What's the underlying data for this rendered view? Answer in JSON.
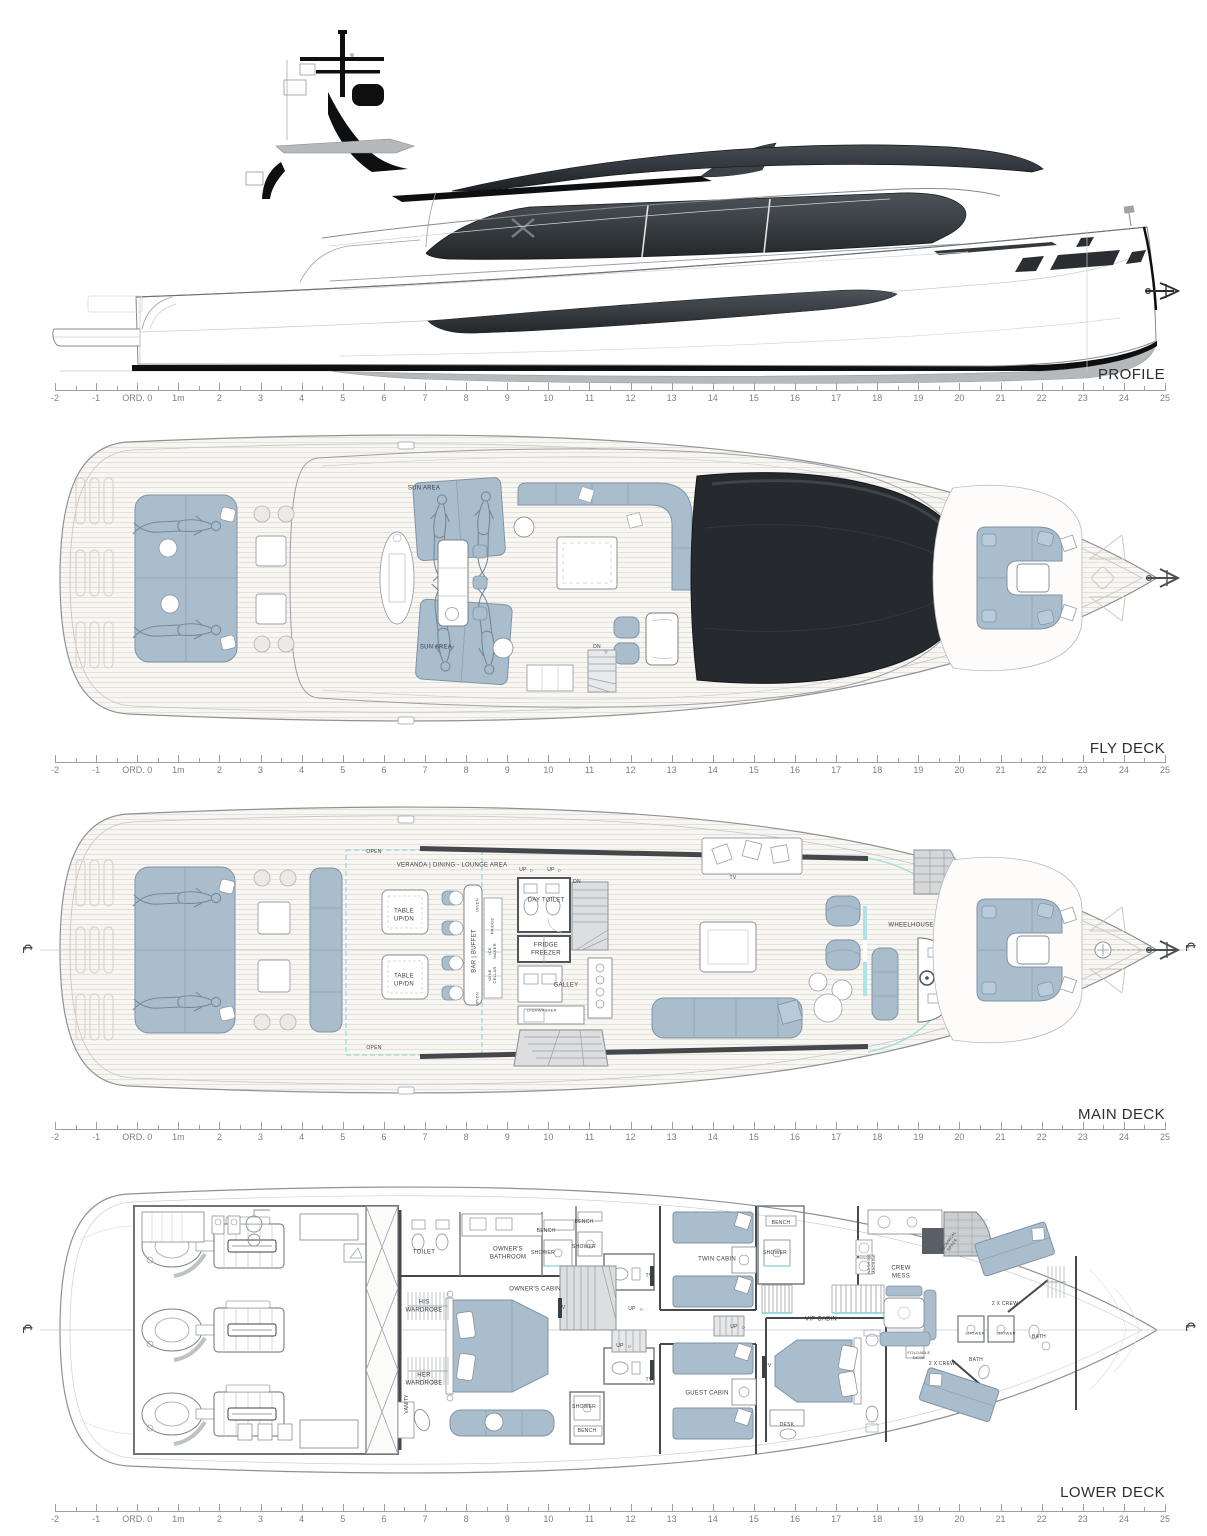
{
  "ruler": {
    "labels": [
      "-2",
      "-1",
      "ORD. 0",
      "1m",
      "2",
      "3",
      "4",
      "5",
      "6",
      "7",
      "8",
      "9",
      "10",
      "11",
      "12",
      "13",
      "14",
      "15",
      "16",
      "17",
      "18",
      "19",
      "20",
      "21",
      "22",
      "23",
      "24",
      "25"
    ]
  },
  "colors": {
    "furniture_blue": "#a9bdcd",
    "glass_dark": "#26292d",
    "wall_dark": "#45494d",
    "accent_cyan": "#7fd2da"
  },
  "sections": {
    "profile": {
      "title": "PROFILE",
      "labels": []
    },
    "fly_deck": {
      "title": "FLY DECK",
      "labels": [
        {
          "t": "SUN AREA",
          "x": 424,
          "y": 489
        },
        {
          "t": "SUN AREA",
          "x": 436,
          "y": 648
        },
        {
          "t": "DN",
          "x": 597,
          "y": 647,
          "fs": 5
        },
        {
          "t": "▽",
          "x": 606,
          "y": 652,
          "fs": 4
        }
      ]
    },
    "main_deck": {
      "title": "MAIN DECK",
      "labels": [
        {
          "t": "℄",
          "x": 27,
          "y": 949,
          "fs": 13,
          "r": 90
        },
        {
          "t": "℄",
          "x": 1190,
          "y": 947,
          "fs": 13,
          "r": 90
        },
        {
          "t": "OPEN",
          "x": 374,
          "y": 852,
          "fs": 5
        },
        {
          "t": "OPEN",
          "x": 374,
          "y": 1048,
          "fs": 5
        },
        {
          "t": "VERANDA | DINING - LOUNGE AREA",
          "x": 452,
          "y": 866
        },
        {
          "t": "TABLE\nUP/DN",
          "x": 404,
          "y": 916
        },
        {
          "t": "TABLE\nUP/DN",
          "x": 404,
          "y": 981
        },
        {
          "t": "BAR | BUFFET",
          "x": 475,
          "y": 951,
          "r": -90
        },
        {
          "t": "UP/DN",
          "x": 477,
          "y": 905,
          "r": -90,
          "fs": 4
        },
        {
          "t": "UP/DN",
          "x": 477,
          "y": 999,
          "r": -90,
          "fs": 4
        },
        {
          "t": "FRIDGE",
          "x": 492,
          "y": 926,
          "r": -90,
          "fs": 4
        },
        {
          "t": "ICE\nMAKER",
          "x": 492,
          "y": 951,
          "r": -90,
          "fs": 4
        },
        {
          "t": "WINE\nCELLAR",
          "x": 492,
          "y": 975,
          "r": -90,
          "fs": 4
        },
        {
          "t": "UP",
          "x": 523,
          "y": 870,
          "fs": 5
        },
        {
          "t": "▷",
          "x": 532,
          "y": 870,
          "fs": 4
        },
        {
          "t": "UP",
          "x": 551,
          "y": 870,
          "fs": 5
        },
        {
          "t": "▷",
          "x": 560,
          "y": 870,
          "fs": 4
        },
        {
          "t": "DN",
          "x": 577,
          "y": 882,
          "fs": 5
        },
        {
          "t": "DAY TOILET",
          "x": 546,
          "y": 901
        },
        {
          "t": "FRIDGE\nFREEZER",
          "x": 546,
          "y": 950
        },
        {
          "t": "GALLEY",
          "x": 566,
          "y": 986
        },
        {
          "t": "DISHWASHER",
          "x": 542,
          "y": 1010,
          "fs": 4
        },
        {
          "t": "TV",
          "x": 733,
          "y": 878,
          "fs": 5
        },
        {
          "t": "WHEELHOUSE",
          "x": 911,
          "y": 926
        }
      ]
    },
    "lower_deck": {
      "title": "LOWER DECK",
      "labels": [
        {
          "t": "℄",
          "x": 27,
          "y": 1329,
          "fs": 13,
          "r": 90
        },
        {
          "t": "℄",
          "x": 1190,
          "y": 1327,
          "fs": 13,
          "r": 90
        },
        {
          "t": "TOILET",
          "x": 424,
          "y": 1253
        },
        {
          "t": "OWNER'S\nBATHROOM",
          "x": 508,
          "y": 1254
        },
        {
          "t": "BENCH",
          "x": 546,
          "y": 1231,
          "fs": 5
        },
        {
          "t": "SHOWER",
          "x": 543,
          "y": 1253,
          "fs": 5
        },
        {
          "t": "BENCH",
          "x": 584,
          "y": 1222,
          "fs": 5
        },
        {
          "t": "SHOWER",
          "x": 584,
          "y": 1247,
          "fs": 5
        },
        {
          "t": "OWNER'S CABIN",
          "x": 535,
          "y": 1290
        },
        {
          "t": "HIS\nWARDROBE",
          "x": 424,
          "y": 1307
        },
        {
          "t": "HER\nWARDROBE",
          "x": 424,
          "y": 1380
        },
        {
          "t": "VANITY",
          "x": 407,
          "y": 1404,
          "r": -90,
          "fs": 5
        },
        {
          "t": "TV",
          "x": 562,
          "y": 1308,
          "fs": 5
        },
        {
          "t": "UP",
          "x": 632,
          "y": 1309,
          "fs": 5
        },
        {
          "t": "▷",
          "x": 642,
          "y": 1309,
          "fs": 4
        },
        {
          "t": "UP",
          "x": 620,
          "y": 1346,
          "fs": 5
        },
        {
          "t": "▷",
          "x": 630,
          "y": 1346,
          "fs": 4
        },
        {
          "t": "SHOWER",
          "x": 584,
          "y": 1407,
          "fs": 5
        },
        {
          "t": "BENCH",
          "x": 587,
          "y": 1431,
          "fs": 5
        },
        {
          "t": "TV",
          "x": 649,
          "y": 1276,
          "fs": 5
        },
        {
          "t": "TV",
          "x": 649,
          "y": 1380,
          "fs": 5
        },
        {
          "t": "TWIN CABIN",
          "x": 717,
          "y": 1260
        },
        {
          "t": "BENCH",
          "x": 781,
          "y": 1223,
          "fs": 5
        },
        {
          "t": "SHOWER",
          "x": 775,
          "y": 1253,
          "fs": 5
        },
        {
          "t": "UP",
          "x": 734,
          "y": 1327,
          "fs": 5
        },
        {
          "t": "▷",
          "x": 744,
          "y": 1327,
          "fs": 4
        },
        {
          "t": "CREW\nMESS",
          "x": 901,
          "y": 1273
        },
        {
          "t": "WASHING\nMACHINE",
          "x": 871,
          "y": 1264,
          "r": -90,
          "fs": 4
        },
        {
          "t": "VIP CABIN",
          "x": 821,
          "y": 1320
        },
        {
          "t": "TV",
          "x": 768,
          "y": 1366,
          "fs": 5
        },
        {
          "t": "GUEST CABIN",
          "x": 707,
          "y": 1394
        },
        {
          "t": "DESK",
          "x": 787,
          "y": 1425,
          "fs": 5
        },
        {
          "t": "FOLDABLE\nDESK",
          "x": 919,
          "y": 1355,
          "fs": 4
        },
        {
          "t": "2 X CREW",
          "x": 1005,
          "y": 1304,
          "fs": 5
        },
        {
          "t": "2 X CREW",
          "x": 942,
          "y": 1364,
          "fs": 5
        },
        {
          "t": "SHOWER",
          "x": 975,
          "y": 1333,
          "fs": 4
        },
        {
          "t": "SHOWER",
          "x": 1006,
          "y": 1333,
          "fs": 4
        },
        {
          "t": "BATH",
          "x": 1039,
          "y": 1337,
          "fs": 5
        },
        {
          "t": "BATH",
          "x": 976,
          "y": 1360,
          "fs": 5
        },
        {
          "t": "TECHNICAL\nSPACE",
          "x": 950,
          "y": 1243,
          "r": -55,
          "fs": 4
        }
      ]
    }
  }
}
